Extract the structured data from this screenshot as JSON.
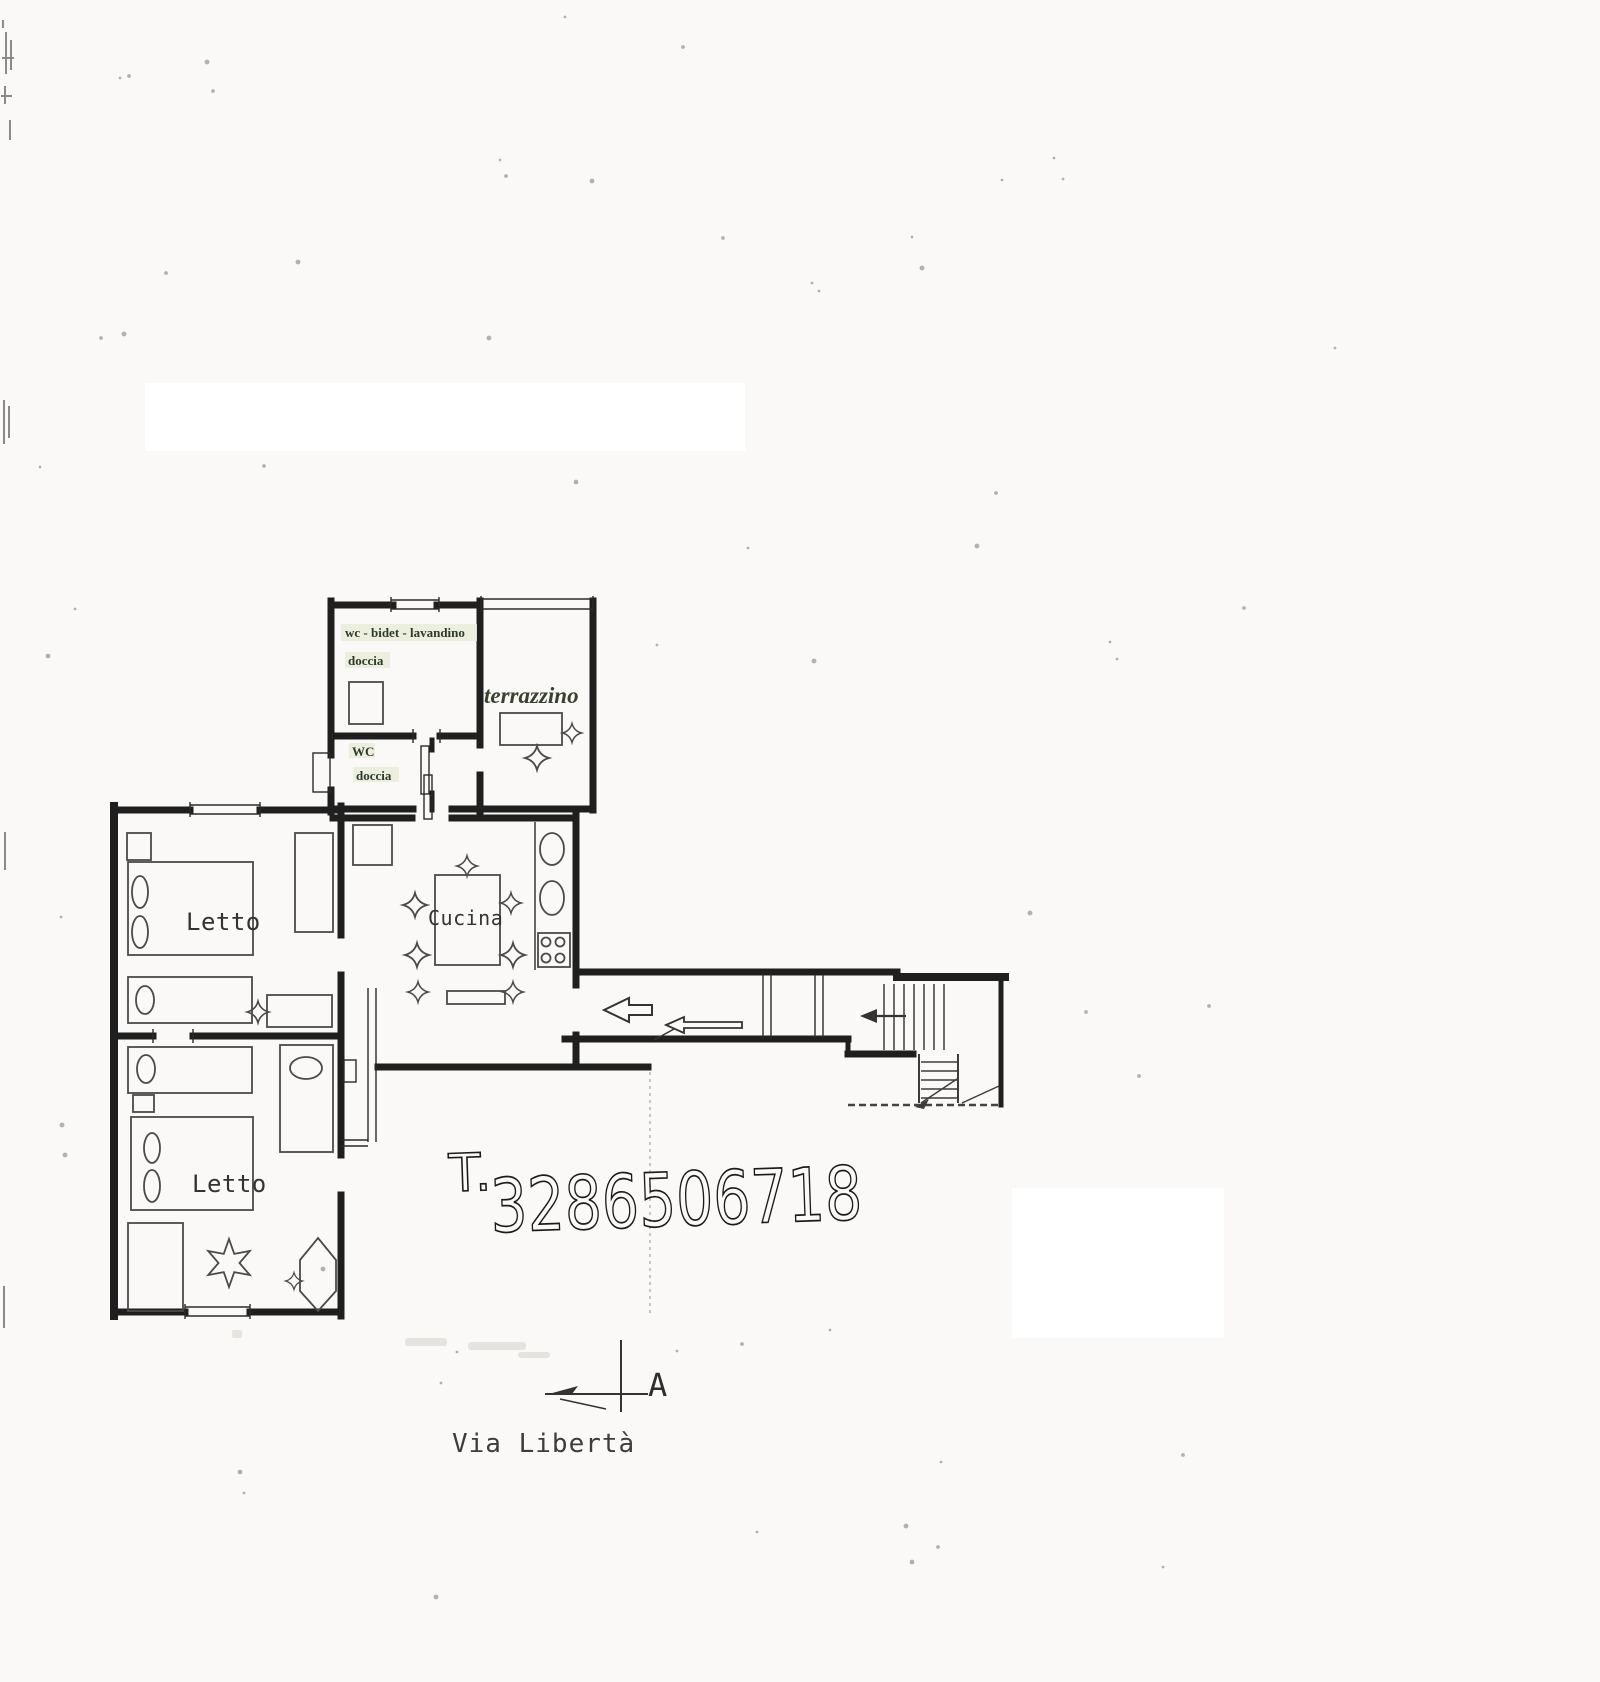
{
  "plan": {
    "rooms": {
      "bagno_top": {
        "label": "wc - bidet - lavandino",
        "sublabel": "doccia"
      },
      "bagno_small": {
        "label": "WC",
        "sublabel": "doccia"
      },
      "terrazzino": {
        "label": "terrazzino"
      },
      "letto_top": {
        "label": "Letto"
      },
      "letto_bottom": {
        "label": "Letto"
      },
      "cucina": {
        "label": "Cucina"
      }
    },
    "annotations": {
      "phone_prefix": "T.",
      "phone_number": "3286506718",
      "street_name": "Via Libertà",
      "section_marker": "A"
    },
    "colors": {
      "wall": "#1f1f1f",
      "furniture": "#4a4a4a",
      "label_highlight": "#e9edd8"
    }
  }
}
